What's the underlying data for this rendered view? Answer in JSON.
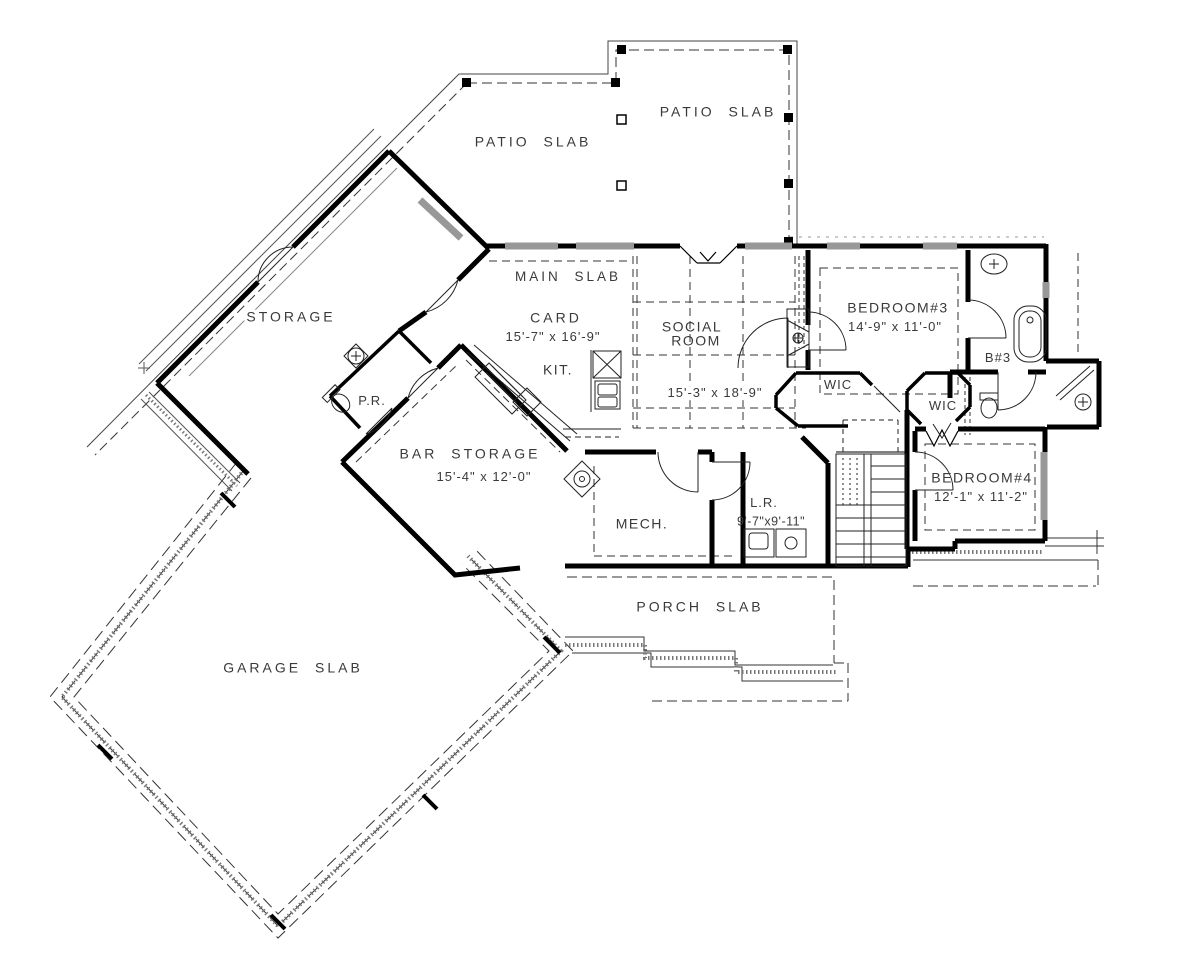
{
  "plan": {
    "slabs": {
      "patio_left": "PATIO SLAB",
      "patio_right": "PATIO SLAB",
      "main": "MAIN SLAB",
      "porch": "PORCH SLAB",
      "garage": "GARAGE SLAB"
    },
    "rooms": {
      "storage": {
        "name": "STORAGE"
      },
      "card": {
        "name": "CARD",
        "dims": "15'-7\" x 16'-9\""
      },
      "kitchen": {
        "name": "KIT."
      },
      "social": {
        "name_line1": "SOCIAL",
        "name_line2": "ROOM",
        "dims": "15'-3\" x 18'-9\""
      },
      "powder": {
        "name": "P.R."
      },
      "bar_storage": {
        "name": "BAR STORAGE",
        "dims": "15'-4\" x 12'-0\""
      },
      "mech": {
        "name": "MECH."
      },
      "laundry": {
        "name": "L.R.",
        "dims": "9'-7\"x9'-11\""
      },
      "bedroom3": {
        "name": "BEDROOM#3",
        "dims": "14'-9\" x 11'-0\""
      },
      "bath3": {
        "name": "B#3"
      },
      "wic_a": {
        "name": "WIC"
      },
      "wic_b": {
        "name": "WIC"
      },
      "bedroom4": {
        "name": "BEDROOM#4",
        "dims": "12'-1\" x 11'-2\""
      }
    },
    "colors": {
      "wall": "#000000",
      "window": "#989898",
      "stipple": "#777777",
      "dash": "#333333",
      "text": "#3a3a3a"
    }
  }
}
